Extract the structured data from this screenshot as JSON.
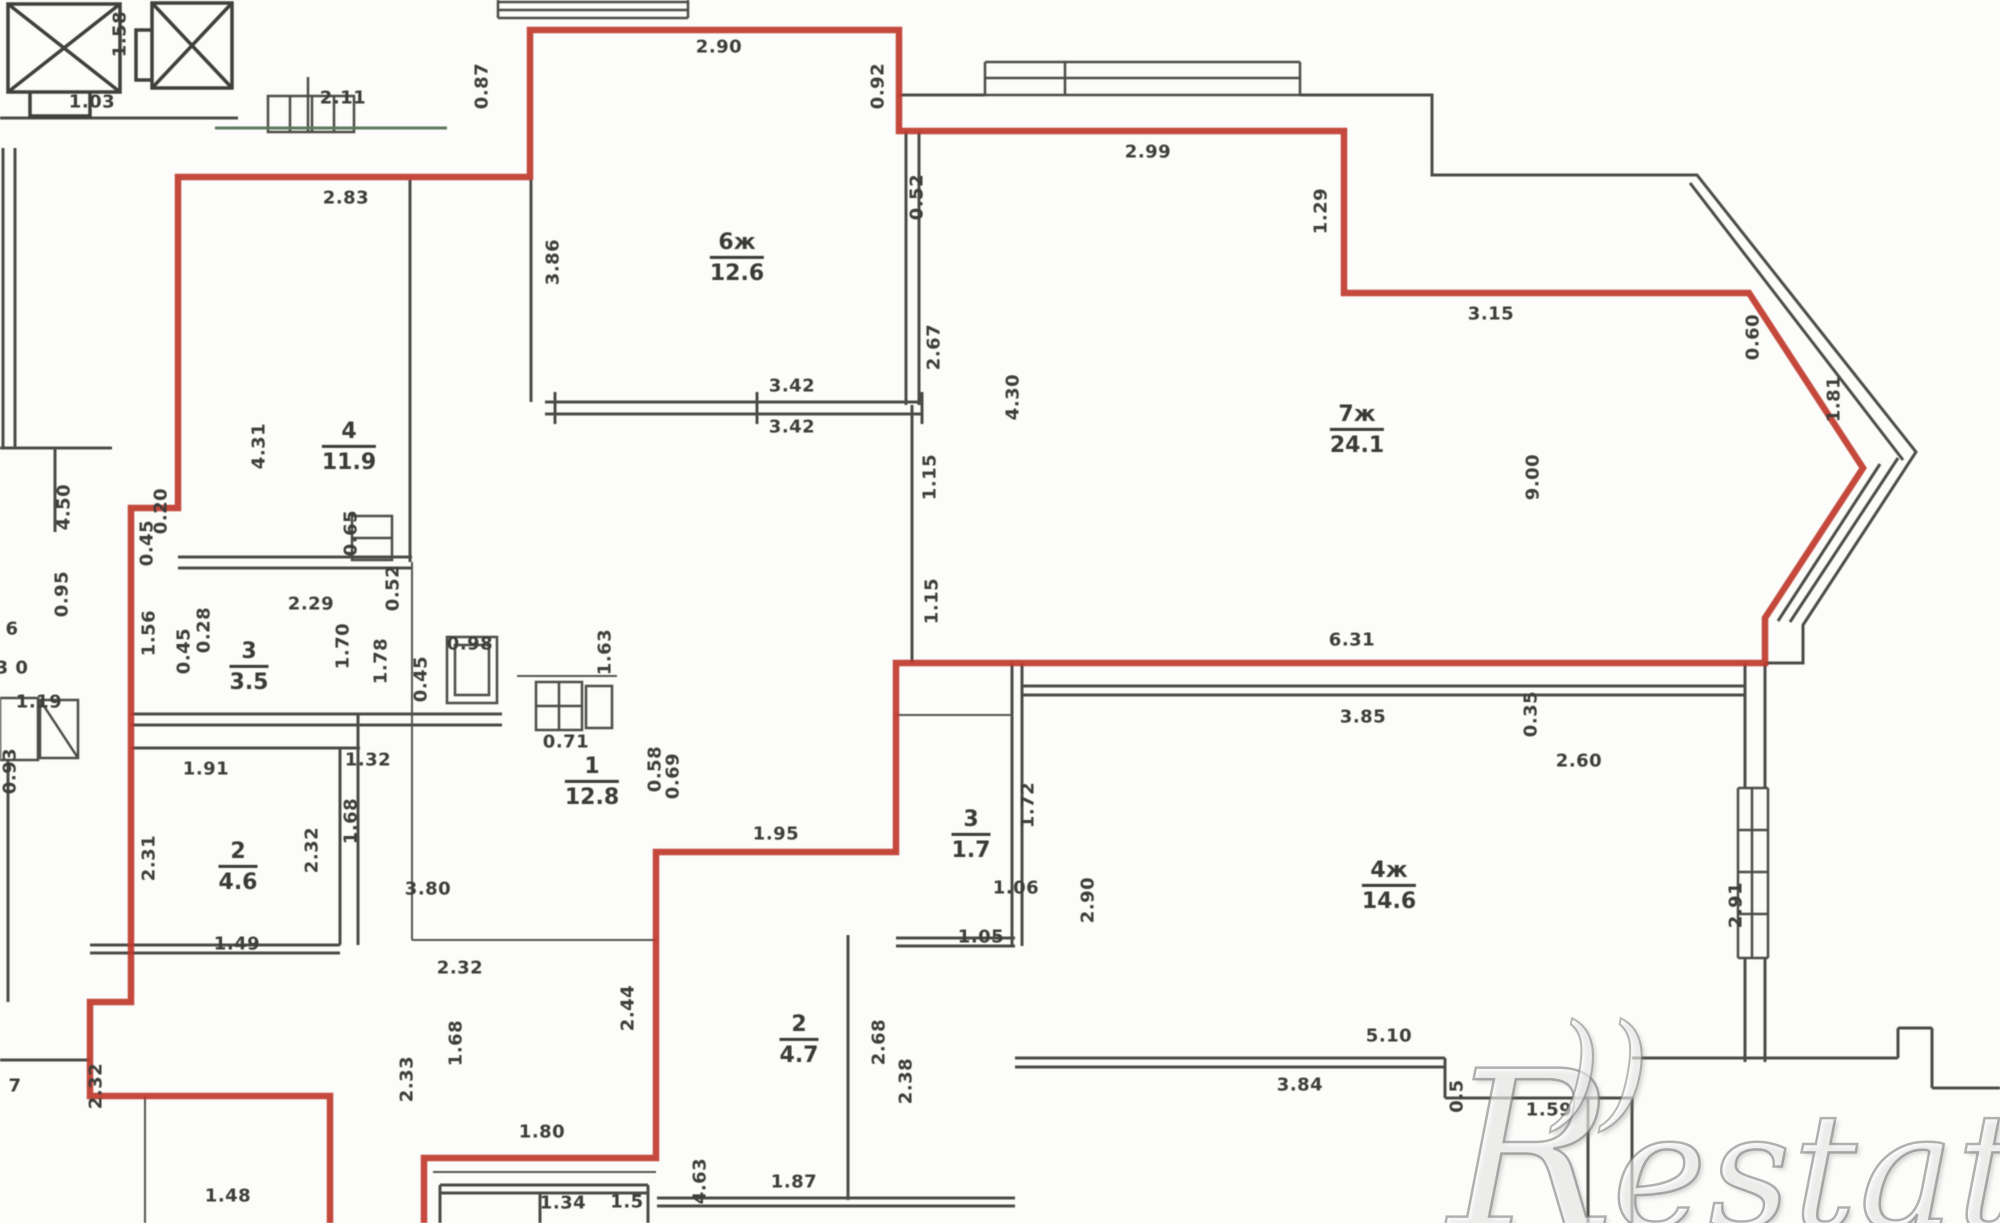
{
  "watermark": {
    "brand": "Restate",
    "logo": "R",
    "arcs": "))",
    "text": "estate"
  },
  "colors": {
    "boundary_red": "#bf3a2b",
    "wall_gray": "#4b4b47",
    "text_gray": "#3d3d3a",
    "scan_green": "#5d7a60",
    "background": "#fcfcfa"
  },
  "rooms": [
    {
      "number": "4",
      "area": "11.9",
      "x": 349,
      "y": 447
    },
    {
      "number": "6ж",
      "area": "12.6",
      "x": 737,
      "y": 258
    },
    {
      "number": "7ж",
      "area": "24.1",
      "x": 1357,
      "y": 430
    },
    {
      "number": "1",
      "area": "12.8",
      "x": 592,
      "y": 782
    },
    {
      "number": "3",
      "area": "3.5",
      "x": 249,
      "y": 667
    },
    {
      "number": "3",
      "area": "1.7",
      "x": 971,
      "y": 835
    },
    {
      "number": "4ж",
      "area": "14.6",
      "x": 1389,
      "y": 886
    },
    {
      "number": "2",
      "area": "4.7",
      "x": 799,
      "y": 1040
    },
    {
      "number": "2",
      "area": "4.6",
      "x": 238,
      "y": 867
    }
  ],
  "dims": [
    {
      "t": "2.11",
      "x": 343,
      "y": 98
    },
    {
      "t": "1.58",
      "x": 120,
      "y": 34,
      "v": true
    },
    {
      "t": "1.03",
      "x": 92,
      "y": 102
    },
    {
      "t": "2.83",
      "x": 346,
      "y": 198
    },
    {
      "t": "0.87",
      "x": 482,
      "y": 86,
      "v": true
    },
    {
      "t": "2.90",
      "x": 719,
      "y": 47
    },
    {
      "t": "0.92",
      "x": 878,
      "y": 86,
      "v": true
    },
    {
      "t": "0.52",
      "x": 917,
      "y": 197,
      "v": true
    },
    {
      "t": "2.99",
      "x": 1148,
      "y": 152
    },
    {
      "t": "1.29",
      "x": 1321,
      "y": 211,
      "v": true
    },
    {
      "t": "3.15",
      "x": 1491,
      "y": 314
    },
    {
      "t": "0.60",
      "x": 1753,
      "y": 337,
      "v": true
    },
    {
      "t": "1.81",
      "x": 1834,
      "y": 399,
      "v": true
    },
    {
      "t": "3.86",
      "x": 553,
      "y": 262,
      "v": true
    },
    {
      "t": "2.67",
      "x": 934,
      "y": 347,
      "v": true
    },
    {
      "t": "4.30",
      "x": 1013,
      "y": 397,
      "v": true
    },
    {
      "t": "4.31",
      "x": 259,
      "y": 446,
      "v": true
    },
    {
      "t": "3.42",
      "x": 792,
      "y": 386
    },
    {
      "t": "3.42",
      "x": 792,
      "y": 427
    },
    {
      "t": "9.00",
      "x": 1533,
      "y": 477,
      "v": true
    },
    {
      "t": "1.15",
      "x": 930,
      "y": 477,
      "v": true
    },
    {
      "t": "1.15",
      "x": 932,
      "y": 601,
      "v": true
    },
    {
      "t": "6.31",
      "x": 1352,
      "y": 640
    },
    {
      "t": "0.20",
      "x": 161,
      "y": 511,
      "v": true
    },
    {
      "t": "0.45",
      "x": 147,
      "y": 543,
      "v": true
    },
    {
      "t": "4.50",
      "x": 64,
      "y": 507,
      "v": true
    },
    {
      "t": "0.95",
      "x": 62,
      "y": 594,
      "v": true
    },
    {
      "t": "1.56",
      "x": 149,
      "y": 633,
      "v": true
    },
    {
      "t": "0.28",
      "x": 204,
      "y": 630,
      "v": true
    },
    {
      "t": "0.45",
      "x": 184,
      "y": 651,
      "v": true
    },
    {
      "t": "2.29",
      "x": 311,
      "y": 604
    },
    {
      "t": "0.65",
      "x": 351,
      "y": 533,
      "v": true
    },
    {
      "t": "0.52",
      "x": 393,
      "y": 588,
      "v": true
    },
    {
      "t": "1.70",
      "x": 343,
      "y": 646,
      "v": true
    },
    {
      "t": "1.78",
      "x": 381,
      "y": 661,
      "v": true
    },
    {
      "t": "1.63",
      "x": 605,
      "y": 652,
      "v": true
    },
    {
      "t": "0.45",
      "x": 421,
      "y": 679,
      "v": true
    },
    {
      "t": "0.98",
      "x": 470,
      "y": 644
    },
    {
      "t": "0.71",
      "x": 566,
      "y": 742
    },
    {
      "t": "0.58",
      "x": 655,
      "y": 769,
      "v": true
    },
    {
      "t": "0.69",
      "x": 673,
      "y": 776,
      "v": true
    },
    {
      "t": "1.95",
      "x": 776,
      "y": 834
    },
    {
      "t": "3.80",
      "x": 428,
      "y": 889
    },
    {
      "t": "1.91",
      "x": 206,
      "y": 769
    },
    {
      "t": "1.32",
      "x": 368,
      "y": 760
    },
    {
      "t": "2.31",
      "x": 149,
      "y": 858,
      "v": true
    },
    {
      "t": "2.32",
      "x": 312,
      "y": 850,
      "v": true
    },
    {
      "t": "1.68",
      "x": 351,
      "y": 821,
      "v": true
    },
    {
      "t": "1.49",
      "x": 237,
      "y": 944
    },
    {
      "t": "1.06",
      "x": 1016,
      "y": 888
    },
    {
      "t": "1.05",
      "x": 981,
      "y": 937
    },
    {
      "t": "1.72",
      "x": 1028,
      "y": 805,
      "v": true
    },
    {
      "t": "2.90",
      "x": 1088,
      "y": 900,
      "v": true
    },
    {
      "t": "3.85",
      "x": 1363,
      "y": 717
    },
    {
      "t": "0.35",
      "x": 1531,
      "y": 714,
      "v": true
    },
    {
      "t": "2.60",
      "x": 1579,
      "y": 761
    },
    {
      "t": "2.91",
      "x": 1736,
      "y": 905,
      "v": true
    },
    {
      "t": "5.10",
      "x": 1389,
      "y": 1036
    },
    {
      "t": "3.84",
      "x": 1300,
      "y": 1085
    },
    {
      "t": "0.5",
      "x": 1457,
      "y": 1096,
      "v": true
    },
    {
      "t": "1.59",
      "x": 1549,
      "y": 1110
    },
    {
      "t": "2.32",
      "x": 460,
      "y": 968
    },
    {
      "t": "1.68",
      "x": 456,
      "y": 1043,
      "v": true
    },
    {
      "t": "2.33",
      "x": 407,
      "y": 1079,
      "v": true
    },
    {
      "t": "2.44",
      "x": 628,
      "y": 1008,
      "v": true
    },
    {
      "t": "1.80",
      "x": 542,
      "y": 1132
    },
    {
      "t": "2.68",
      "x": 879,
      "y": 1042,
      "v": true
    },
    {
      "t": "2.38",
      "x": 906,
      "y": 1081,
      "v": true
    },
    {
      "t": "1.87",
      "x": 794,
      "y": 1182
    },
    {
      "t": "4.63",
      "x": 700,
      "y": 1181,
      "v": true
    },
    {
      "t": "1.34",
      "x": 563,
      "y": 1203
    },
    {
      "t": "1.5",
      "x": 627,
      "y": 1202
    },
    {
      "t": "1.48",
      "x": 228,
      "y": 1196
    },
    {
      "t": "6",
      "x": 12,
      "y": 629
    },
    {
      "t": "3 0",
      "x": 12,
      "y": 668
    },
    {
      "t": "1.19",
      "x": 39,
      "y": 702
    },
    {
      "t": "0.93",
      "x": 10,
      "y": 771,
      "v": true
    },
    {
      "t": "7",
      "x": 15,
      "y": 1086
    },
    {
      "t": "2.32",
      "x": 96,
      "y": 1086,
      "v": true
    }
  ]
}
